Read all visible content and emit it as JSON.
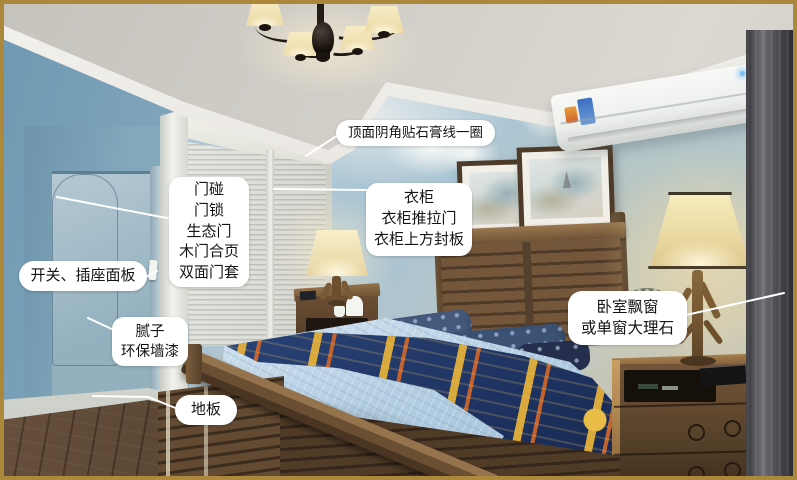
{
  "colors": {
    "frame-gold": "#ab883c",
    "label-bg": "#ffffff",
    "label-text": "#141414",
    "leader-line": "#ffffff"
  },
  "annotations": {
    "ceiling": {
      "text": "顶面阴角贴石膏线一圈"
    },
    "door": {
      "lines": [
        "门碰",
        "门锁",
        "生态门",
        "木门合页",
        "双面门套"
      ]
    },
    "switch_panel": {
      "text": "开关、插座面板"
    },
    "wall_finish": {
      "lines": [
        "腻子",
        "环保墙漆"
      ]
    },
    "floor": {
      "text": "地板"
    },
    "wardrobe": {
      "lines": [
        "衣柜",
        "衣柜推拉门",
        "衣柜上方封板"
      ]
    },
    "bay_window": {
      "lines": [
        "卧室飘窗",
        "或单窗大理石"
      ]
    }
  }
}
